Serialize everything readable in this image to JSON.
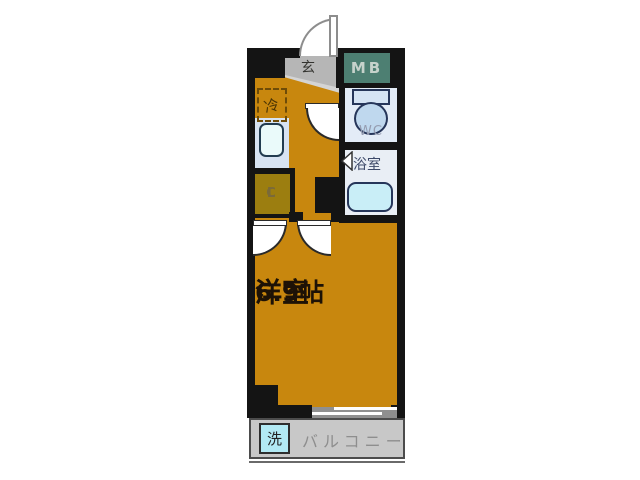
{
  "floorplan": {
    "labels": {
      "genkan": "玄",
      "meter_box": "MB",
      "refrigerator": "冷",
      "wc": "WC",
      "bathroom": "浴室",
      "closet_line1": "C",
      "closet_line2": "L",
      "main_room_name": "洋室",
      "main_room_size": "6.9帖",
      "washer": "洗",
      "balcony": "バルコニー"
    },
    "colors": {
      "floor_orange": "#c8870e",
      "wall_black": "#141414",
      "genkan_gray": "#b6b6b6",
      "meter_box_teal": "#4d7f72",
      "wet_area_bg": "#e3ecf7",
      "fixture_blue": "#bfd8ee",
      "bathtub_blue": "#c9eef7",
      "kitchen_bg": "#d7e3f2",
      "closet_olive": "#9c7e10",
      "balcony_gray": "#c8c8c8",
      "washer_cyan": "#b2eaf4",
      "room_text": "#1d1206"
    }
  }
}
